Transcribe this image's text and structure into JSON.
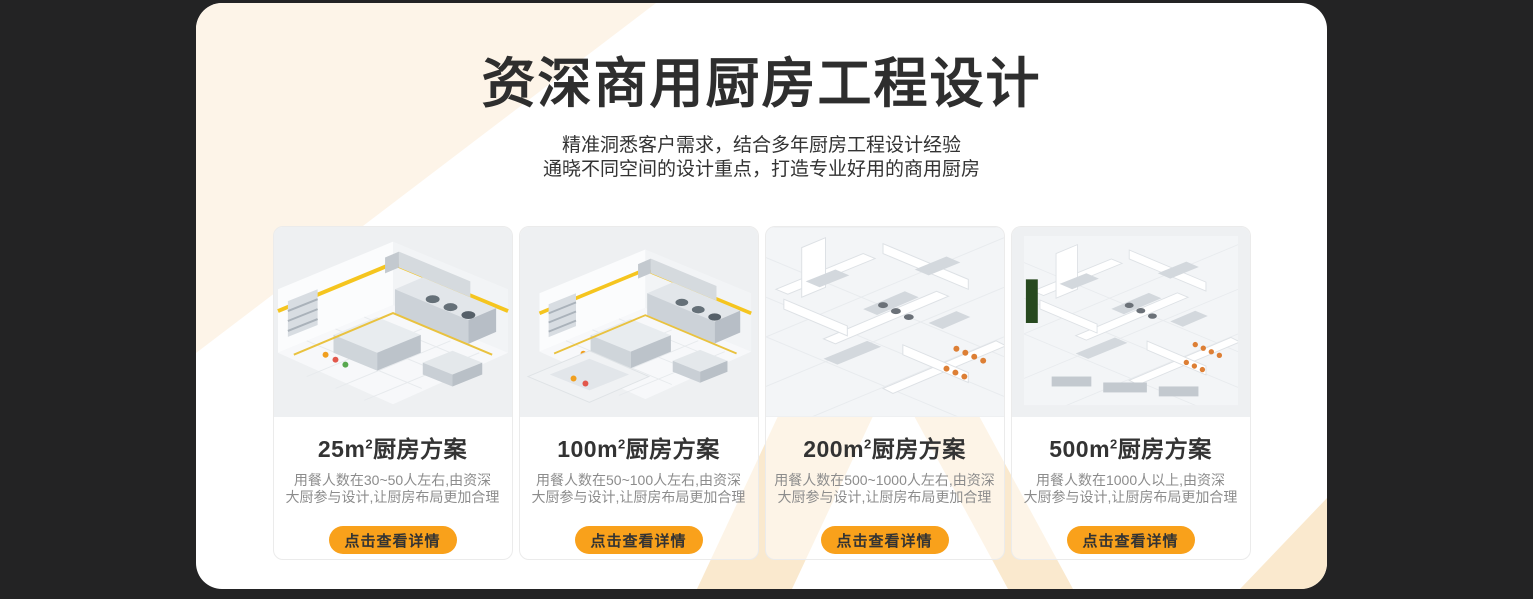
{
  "colors": {
    "background": "#232324",
    "panel": "#ffffff",
    "accent_orange": "#F9A11B",
    "pattern_peach": "#FAE9CE",
    "pattern_peach_light": "#FDF4E8",
    "heading_text": "#2e2e2e",
    "description_text": "#8c8c8c",
    "safety_stripe_yellow": "#F5C51F"
  },
  "header": {
    "title": "资深商用厨房工程设计",
    "subtitle_line1": "精准洞悉客户需求，结合多年厨房工程设计经验",
    "subtitle_line2": "通晓不同空间的设计重点，打造专业好用的商用厨房"
  },
  "cards": [
    {
      "area_label": "25m",
      "area_sup": "2",
      "title_suffix": "厨房方案",
      "description_line1": "用餐人数在30~50人左右,由资深",
      "description_line2": "大厨参与设计,让厨房布局更加合理",
      "button_label": "点击查看详情",
      "image_name": "kitchen-isometric-render-25m2"
    },
    {
      "area_label": "100m",
      "area_sup": "2",
      "title_suffix": "厨房方案",
      "description_line1": "用餐人数在50~100人左右,由资深",
      "description_line2": "大厨参与设计,让厨房布局更加合理",
      "button_label": "点击查看详情",
      "image_name": "kitchen-isometric-render-100m2"
    },
    {
      "area_label": "200m",
      "area_sup": "2",
      "title_suffix": "厨房方案",
      "description_line1": "用餐人数在500~1000人左右,由资深",
      "description_line2": "大厨参与设计,让厨房布局更加合理",
      "button_label": "点击查看详情",
      "image_name": "kitchen-floorplan-render-200m2"
    },
    {
      "area_label": "500m",
      "area_sup": "2",
      "title_suffix": "厨房方案",
      "description_line1": "用餐人数在1000人以上,由资深",
      "description_line2": "大厨参与设计,让厨房布局更加合理",
      "button_label": "点击查看详情",
      "image_name": "kitchen-floorplan-render-500m2"
    }
  ]
}
